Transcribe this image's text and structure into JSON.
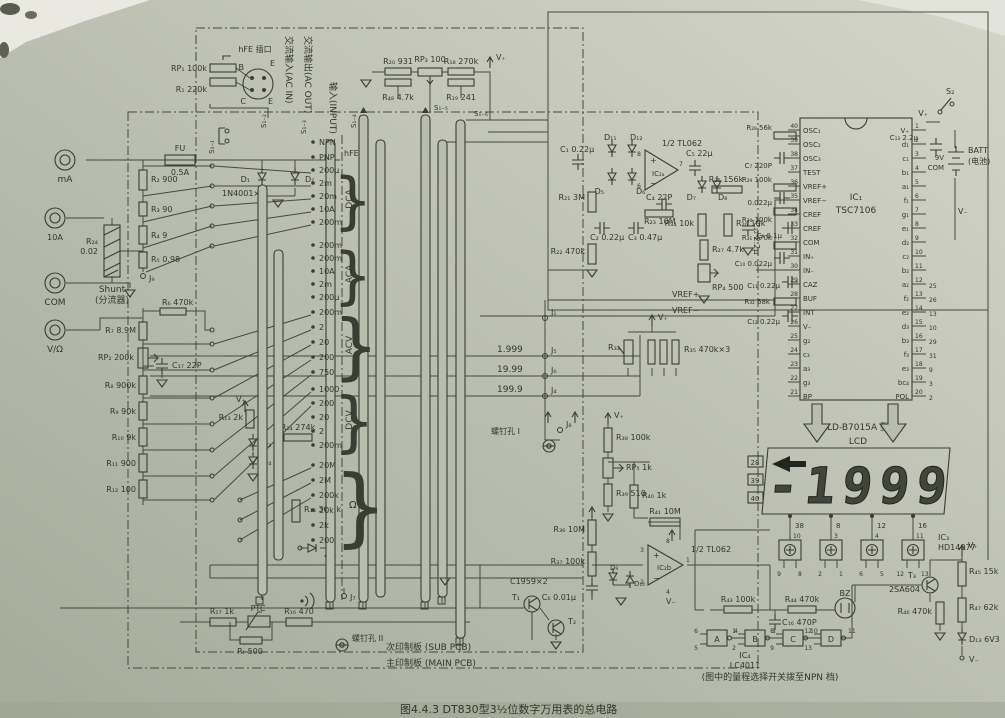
{
  "page": {
    "caption": "图4.4.3  DT830型3½位数字万用表的总电路",
    "paper": "#b9bdae",
    "ink": "#3a3e34"
  },
  "notes": {
    "ac_in": "交流输入(AC IN)",
    "ac_out": "交流输出(AC OUT)",
    "input": "输入(INPUT)",
    "sub_pcb": "次印制板 (SUB PCB)",
    "main_pcb": "主印制板 (MAIN PCB)",
    "screw1": "螺钉孔 I",
    "screw2": "螺钉孔 II",
    "range_note": "(图中的量程选择开关拨至NPN 档)"
  },
  "jacks": {
    "ma": "mA",
    "a10": "10A",
    "com": "COM",
    "vohm": "V/Ω"
  },
  "input_sec": {
    "fu": "FU",
    "fu_val": "0.5A",
    "d1": "D₁",
    "d2": "D₂",
    "dtype": "1N4001×2",
    "shunt_ref": "R₂₄",
    "shunt_val": "0.02",
    "shunt_en": "Shunt",
    "shunt_cn": "(分流器)",
    "r2": "R₂ 900",
    "r3": "R₃ 90",
    "r4": "R₄ 9",
    "r5": "R₅ 0.98",
    "j9": "J₉"
  },
  "divider": {
    "r6": "R₆ 470k",
    "r7": "R₇ 8.9M",
    "rp2": "RP₂ 200k",
    "c17": "C₁₇ 22P",
    "r8": "R₈ 900k",
    "r9": "R₉ 90k",
    "r10": "R₁₀ 9k",
    "r11": "R₁₁ 900",
    "r12": "R₁₂ 100",
    "r13": "R₁₃ 2k",
    "d3": "D₃",
    "d4": "D₄",
    "r14": "R₁₄ 274k",
    "r15": "R₁₅ 30.1k"
  },
  "hfe": {
    "title": "hFE 插口",
    "rp1": "RP₁ 100k",
    "r1": "R₁ 220k",
    "b": "B",
    "e_top": "E",
    "c": "C",
    "e_bot": "E"
  },
  "sw": {
    "s11": "S₁₋₁",
    "s12": "S₁₋₂",
    "s13": "S₁₋₃",
    "s14": "S₁₋₄",
    "s15": "S₁₋₅",
    "s16": "S₁₋₆"
  },
  "topmid": {
    "r20": "R₂₀ 931",
    "rp3": "RP₃ 100",
    "r18": "R₁₈ 270k",
    "r48": "R₄₈ 4.7k",
    "r19": "R₁₉ 241",
    "vp": "V₊"
  },
  "ranges": {
    "hfe": {
      "label": "hFE",
      "items": [
        "NPN",
        "PNP"
      ]
    },
    "dca": {
      "label": "DCA",
      "items": [
        "200μ",
        "2m",
        "20m",
        "10A",
        "200m"
      ]
    },
    "aca": {
      "label": "ACA",
      "items": [
        "200m",
        "200m",
        "10A",
        "2m",
        "200μ"
      ]
    },
    "acv": {
      "label": "ACV",
      "items": [
        "200m",
        "2",
        "20",
        "200",
        "750"
      ]
    },
    "dcv": {
      "label": "DCV",
      "items": [
        "1000",
        "200",
        "20",
        "2",
        "200m"
      ]
    },
    "ohm": {
      "label": "Ω",
      "items": [
        "20M",
        "2M",
        "200k",
        "20k",
        "2k",
        "200"
      ]
    }
  },
  "acdc": {
    "c1": "C₁ 0.22μ",
    "d11": "D₁₁",
    "d12": "D₁₂",
    "d5": "D₅",
    "d6": "D₆",
    "amp": "IC₂ₐ",
    "half": "1/2 TL062",
    "p8": "8",
    "p6": "6",
    "p7": "7",
    "c4": "C₄ 22P",
    "r23": "R₂₃ 10M",
    "c2": "C₂ 0.22μ",
    "c3": "C₃ 0.47μ",
    "r21": "R₂₁ 3M",
    "r22": "R₂₂ 470k",
    "c5": "C₅ 22μ",
    "d7": "D₇",
    "d8": "D₈",
    "r25": "R₂₅ 156k",
    "r34": "R₃₄ 10k",
    "r26": "R₂₆ 10k",
    "r27": "R₂₇ 4.7k",
    "rp4": "RP₄ 500",
    "c22": "C₂₂ 2.2μ"
  },
  "refsec": {
    "vrefp": "VREF+",
    "vrefm": "VREF−",
    "j1": "J₁",
    "j5": "J₅",
    "j6": "J₆",
    "j4": "J₄",
    "j8": "J₈",
    "j7": "J₇",
    "cal1": "1.999",
    "cal2": "19.99",
    "cal3": "199.9",
    "r33": "R₃₃",
    "r35": "R₃₅ 470k×3",
    "vp": "V₊"
  },
  "cmp": {
    "r36": "R₃₆ 10M",
    "r37": "R₃₇ 100k",
    "r38": "R₃₈ 100k",
    "rp5": "RP₅ 1k",
    "r39": "R₃₉ 510",
    "r40": "R₄₀ 1k",
    "r41": "R₄₁ 10M",
    "amp": "IC₂b",
    "half": "1/2 TL062",
    "c6": "C₆ 0.01μ",
    "d9": "D₉",
    "d10": "D₁₀",
    "p3": "3",
    "p2": "2",
    "p8": "8",
    "p4": "4",
    "p1": "1",
    "vp": "V₊",
    "vm": "V₋"
  },
  "ic1": {
    "ref": "IC₁",
    "part": "TSC7106",
    "left_pins": [
      {
        "name": "OSC₁",
        "num": "40"
      },
      {
        "name": "OSC₂",
        "num": "39"
      },
      {
        "name": "OSC₃",
        "num": "38"
      },
      {
        "name": "TEST",
        "num": "37"
      },
      {
        "name": "VREF+",
        "num": "36"
      },
      {
        "name": "VREF−",
        "num": "35"
      },
      {
        "name": "CREF",
        "num": "34"
      },
      {
        "name": "CREF",
        "num": "33"
      },
      {
        "name": "COM",
        "num": "32"
      },
      {
        "name": "IN₊",
        "num": "31"
      },
      {
        "name": "IN₋",
        "num": "30"
      },
      {
        "name": "CAZ",
        "num": "29"
      },
      {
        "name": "BUF",
        "num": "28"
      },
      {
        "name": "INT",
        "num": "27"
      },
      {
        "name": "V₋",
        "num": "26"
      },
      {
        "name": "g₂",
        "num": "25"
      },
      {
        "name": "c₃",
        "num": "24"
      },
      {
        "name": "a₃",
        "num": "23"
      },
      {
        "name": "g₃",
        "num": "22"
      },
      {
        "name": "BP",
        "num": "21"
      }
    ],
    "right_pins": [
      {
        "name": "V₊",
        "num": "1"
      },
      {
        "name": "d₁",
        "num": "2"
      },
      {
        "name": "c₁",
        "num": "3"
      },
      {
        "name": "b₁",
        "num": "4"
      },
      {
        "name": "a₁",
        "num": "5"
      },
      {
        "name": "f₁",
        "num": "6"
      },
      {
        "name": "g₁",
        "num": "7"
      },
      {
        "name": "e₁",
        "num": "8"
      },
      {
        "name": "d₂",
        "num": "9"
      },
      {
        "name": "c₂",
        "num": "10"
      },
      {
        "name": "b₂",
        "num": "11"
      },
      {
        "name": "a₂",
        "num": "12",
        "ext": "25"
      },
      {
        "name": "f₂",
        "num": "13",
        "ext": "26"
      },
      {
        "name": "e₂",
        "num": "14",
        "ext": "13"
      },
      {
        "name": "d₃",
        "num": "15",
        "ext": "10"
      },
      {
        "name": "b₃",
        "num": "16",
        "ext": "29"
      },
      {
        "name": "f₃",
        "num": "17",
        "ext": "31"
      },
      {
        "name": "e₃",
        "num": "18",
        "ext": "9"
      },
      {
        "name": "bc₄",
        "num": "19",
        "ext": "3"
      },
      {
        "name": "POL",
        "num": "20",
        "ext": "2"
      }
    ]
  },
  "ic1_parts": {
    "r28": "R₂₈ 56k",
    "c7": "C₇ 220P",
    "r29": "R₂₉ 100k",
    "c9": "0.022μ",
    "r30": "R₃₀ 100k",
    "c8": "C₈ 0.1μ",
    "r31": "R₃₁ 470k",
    "c10": "C₁₀ 0.022μ",
    "c11": "C₁₁ 0.22μ",
    "r32": "R₃₂ 68k",
    "c12": "C₁₂ 0.22μ"
  },
  "power": {
    "s2": "S₂",
    "c13": "C₁₃ 2.2μ",
    "batt": "BATT",
    "batt_cn": "(电池)",
    "v9": "9V",
    "com": "COM",
    "vp": "V₊",
    "vm": "V₋"
  },
  "lcd": {
    "model": "LD-B7015A 型",
    "name": "LCD",
    "reading": "-1999",
    "left_pins": [
      "28",
      "39",
      "40"
    ],
    "bottom_pins": [
      "38",
      "8",
      "12",
      "16"
    ]
  },
  "ic3": {
    "ref": "IC₃",
    "part": "HD14077",
    "vp": "V₊",
    "gates": [
      {
        "top": "10",
        "l": "9",
        "r": "8"
      },
      {
        "top": "3",
        "l": "2",
        "r": "1"
      },
      {
        "top": "4",
        "l": "6",
        "r": "5"
      },
      {
        "top": "11",
        "l": "12",
        "r": "13"
      }
    ]
  },
  "ic4": {
    "ref": "IC₄",
    "part": "LC4011",
    "r43": "R₄₃ 100k",
    "r44": "R₄₄ 470k",
    "c16": "C₁₆ 470P",
    "bz": "BZ",
    "gates": [
      {
        "name": "A",
        "i1": "6",
        "i2": "5",
        "o": "4"
      },
      {
        "name": "B",
        "i1": "1",
        "i2": "2",
        "o": "3"
      },
      {
        "name": "C",
        "i1": "8",
        "i2": "9",
        "o": "10"
      },
      {
        "name": "D",
        "i1": "12",
        "i2": "13",
        "o": "11"
      }
    ]
  },
  "out": {
    "t3": "T₃",
    "t3_part": "2SA604",
    "r45": "R₄₅ 15k",
    "r46": "R₄₆ 470k",
    "r47": "R₄₇ 62k",
    "d13": "D₁₃ 6V3",
    "vp": "V₊",
    "vm": "V₋"
  },
  "bottom": {
    "r17": "R₁₇ 1k",
    "ptc": "PTC",
    "r16": "R₁₆ 470",
    "rt": "Rₜ 500",
    "c1959": "C1959×2",
    "t1": "T₁",
    "t2": "T₂"
  }
}
